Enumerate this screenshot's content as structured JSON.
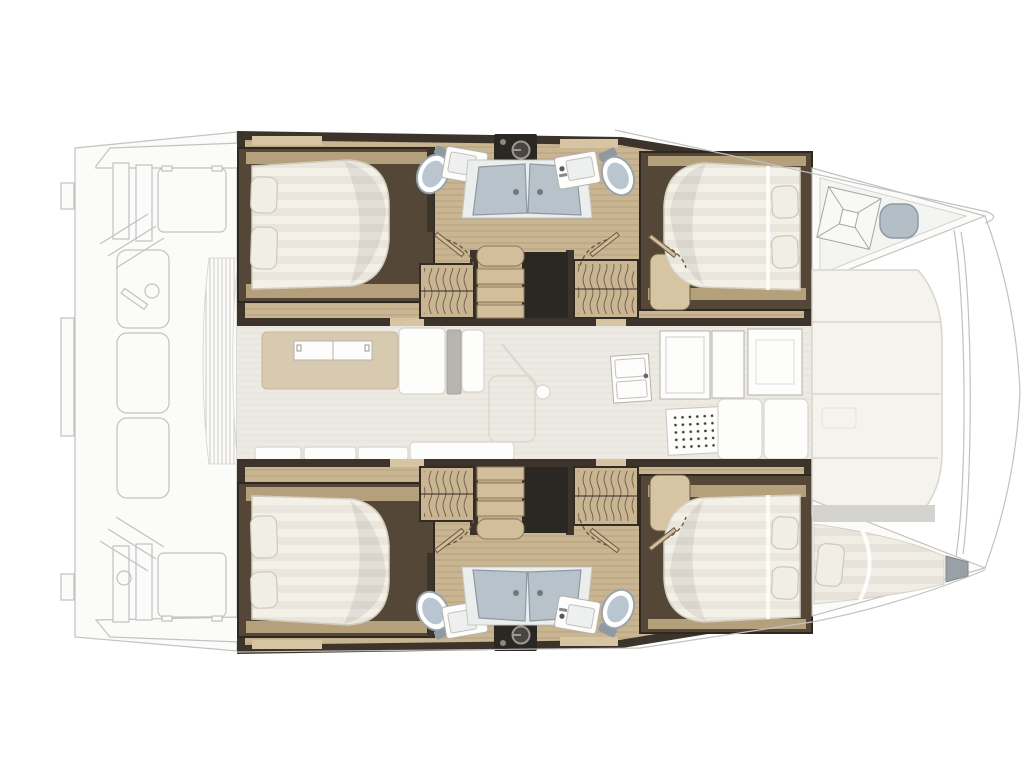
{
  "page": {
    "title": "Catamaran interior layout plan (top view)",
    "orientation": {
      "bow": "right",
      "stern": "left"
    }
  },
  "areas": {
    "port_hull_top": {
      "label": "port hull",
      "rooms": [
        "aft double cabin",
        "aft bathroom",
        "companionway stairs",
        "forward bathroom",
        "forward double cabin",
        "forepeak with deck hatch and seat"
      ],
      "fixtures": [
        "double bed",
        "pillows",
        "hanging lockers",
        "washing machine",
        "shower",
        "sink",
        "toilet"
      ]
    },
    "starboard_hull_bottom": {
      "label": "starboard hull",
      "rooms": [
        "aft double cabin",
        "aft bathroom",
        "companionway stairs",
        "forward bathroom",
        "forward double cabin",
        "forepeak skipper berth"
      ],
      "fixtures": [
        "double bed",
        "pillows",
        "hanging lockers",
        "washing machine",
        "shower",
        "sink",
        "toilet",
        "single berth with pillow"
      ]
    },
    "saloon": {
      "label": "saloon and galley",
      "fixtures": [
        "rug",
        "folding table",
        "sofa",
        "pouf",
        "floor hatch",
        "galley sink",
        "refrigerator cabinets",
        "stove",
        "storage benches",
        "counter cushions"
      ]
    },
    "exterior": {
      "aft": [
        "cockpit bench seats",
        "deck hatches",
        "targa supports",
        "louvered door",
        "transom steps",
        "winch"
      ],
      "forward": [
        "forward cockpit sunpads",
        "forward crossbeam",
        "bow bridle lines",
        "bow tips"
      ]
    }
  },
  "colors": {
    "wall": "#3c342b",
    "hull_shadow": "#2e2820",
    "wood": "#c9b592",
    "wood_mid": "#b5a07c",
    "wood_light": "#d6c4a2",
    "frame": "#554738",
    "mattress": "#f3f0e8",
    "mattress_edge": "#d6cfbf",
    "pillow": "#f1eee6",
    "pillow_edge": "#cfc8b8",
    "shower": "#b7c2ca",
    "shower_edge": "#8d98a1",
    "tray": "#eceeee",
    "toilet_lid": "#b9c6d0",
    "dark_unit": "#2b2723",
    "steps": "#d2be9a",
    "steps_edge": "#8e7a58",
    "rug": "#d8cab1",
    "saloon_floor": "#edeae3",
    "sofa_gray": "#b8b5af",
    "ghost_fill": "#fbfbfa",
    "ghost_stroke": "#c3c2c0",
    "cushion": "#f5f3ed",
    "cushion_stroke": "#d8d5cd",
    "seat": "#b3bec6",
    "door_arc": "#6b5a42",
    "squiggle": "#6e5d46"
  }
}
